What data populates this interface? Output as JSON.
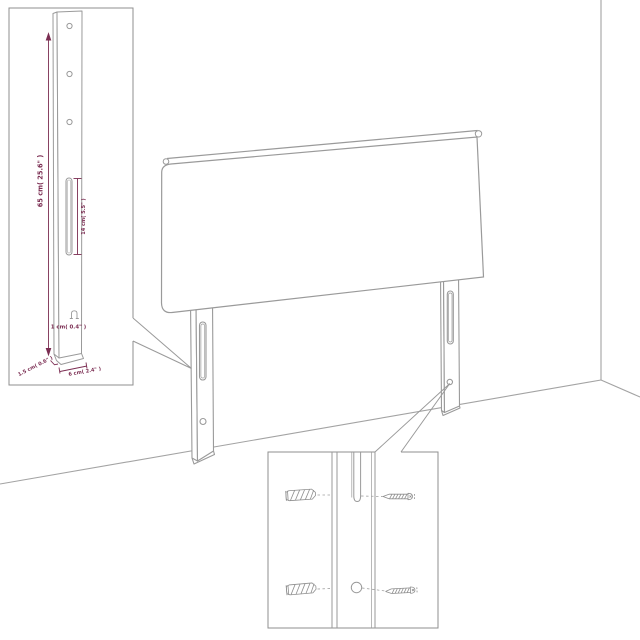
{
  "diagram": {
    "kind": "product-dimension-diagram",
    "subject": "upholstered headboard with two slotted mounting legs standing in a room corner"
  },
  "colors": {
    "background": "#ffffff",
    "outline": "#999999",
    "outline_light": "#aaaaaa",
    "dimension_text": "#7b2d52"
  },
  "leg_inset": {
    "height_label": "65 cm( 25.6\" )",
    "slot_label": "14 cm( 5.5\" )",
    "hook_label": "1 cm( 0.4\" )",
    "thickness_label": "1.5 cm( 0.6\" )",
    "width_label": "6 cm( 2.4\" )",
    "hole_count": 3
  },
  "mount_inset": {
    "anchor_count": 2,
    "screw_count": 2
  },
  "icons": {
    "wall_anchor": "wall-anchor-icon",
    "screw": "screw-icon",
    "mount_hook": "mount-hook-icon"
  }
}
